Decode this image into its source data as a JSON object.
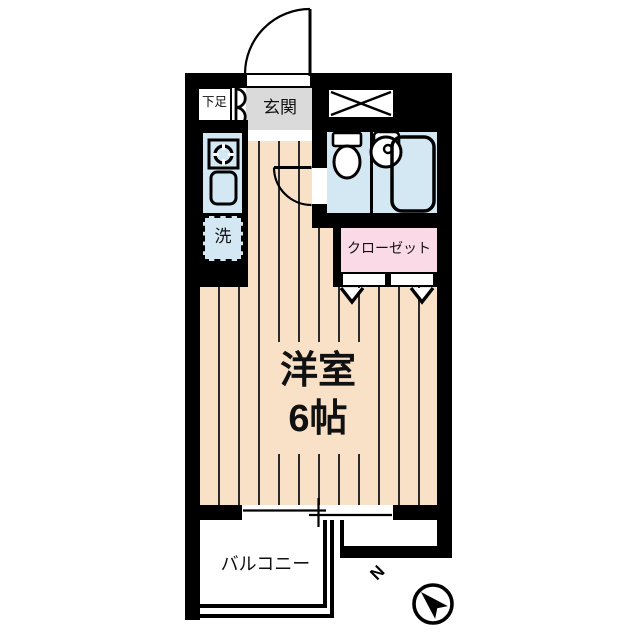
{
  "plan": {
    "type": "apartment-floor-plan",
    "rooms": {
      "shoe_storage": {
        "label": "下足"
      },
      "entrance": {
        "label": "玄関"
      },
      "laundry": {
        "label": "洗"
      },
      "closet": {
        "label": "クローゼット"
      },
      "main_room": {
        "label": "洋室",
        "size": "6帖"
      },
      "balcony": {
        "label": "バルコニー"
      }
    },
    "compass": {
      "north_label": "N",
      "direction": "upper-left"
    },
    "icons": {
      "entrance_door": "swing-door-arc",
      "shoe_cabinet": "double-cabinet-doors",
      "vent_box": "crossed-rectangle",
      "stove": "burner-circle",
      "kitchen_sink": "rounded-rect-sink",
      "toilet": "tank-and-bowl",
      "washbasin": "round-basin",
      "bathtub": "rounded-tub",
      "room_door": "swing-door-arc",
      "closet_doors": "bifold-chevrons",
      "window": "sliding-window-lines",
      "compass": "north-arrow"
    },
    "colors": {
      "paper": "#ffffff",
      "wall": "#000000",
      "floor": "#f8e1c6",
      "floor_stripe": "#2b2b2b",
      "water": "#d4e8f4",
      "closet_pink": "#f9dae6",
      "entrance_gray": "#dadada",
      "line": "#000000"
    }
  }
}
